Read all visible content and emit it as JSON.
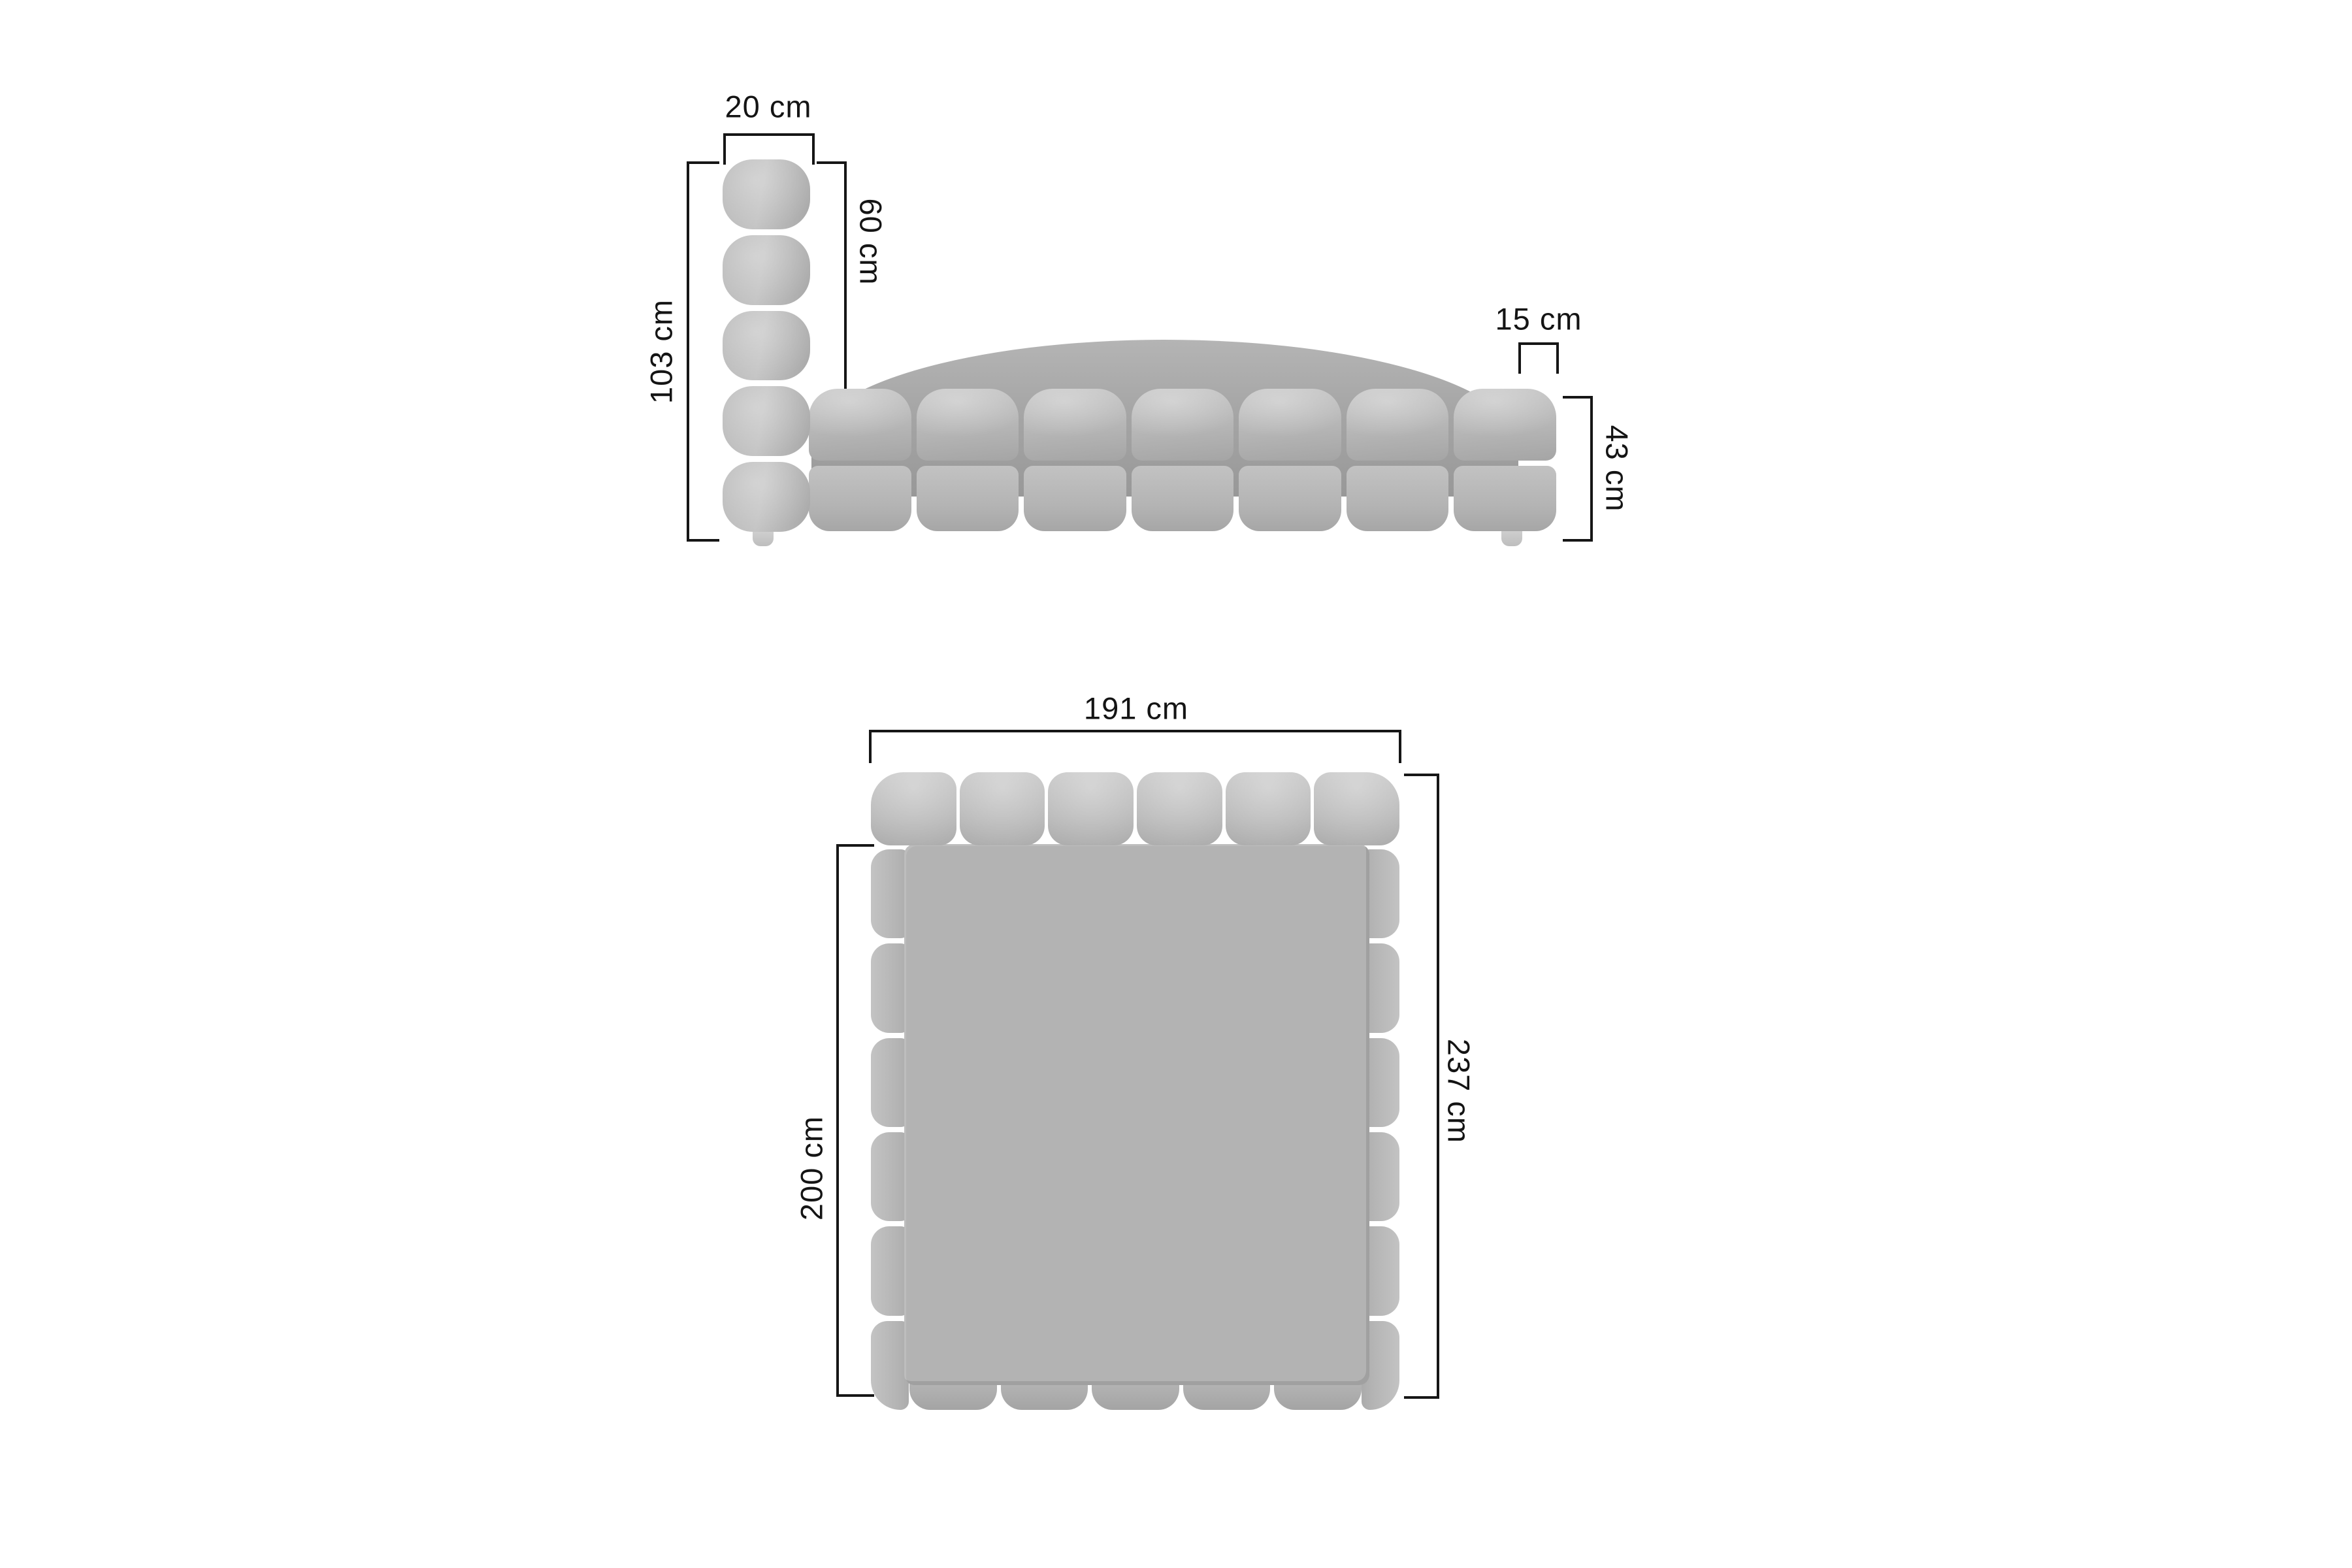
{
  "side": {
    "headboard_width": "20 cm",
    "headboard_above_mattress": "60 cm",
    "total_height": "103 cm",
    "mattress_inset": "15 cm",
    "base_height": "43 cm"
  },
  "top": {
    "overall_width": "191 cm",
    "mattress_width": "160 cm",
    "mattress_length": "200 cm",
    "overall_length": "237 cm"
  },
  "colors": {
    "background": "#ffffff",
    "fabric": "#b7b7b7",
    "fabric_highlight": "#c7c7c7",
    "fabric_shadow": "#989898",
    "dimension_lines": "#161616"
  }
}
